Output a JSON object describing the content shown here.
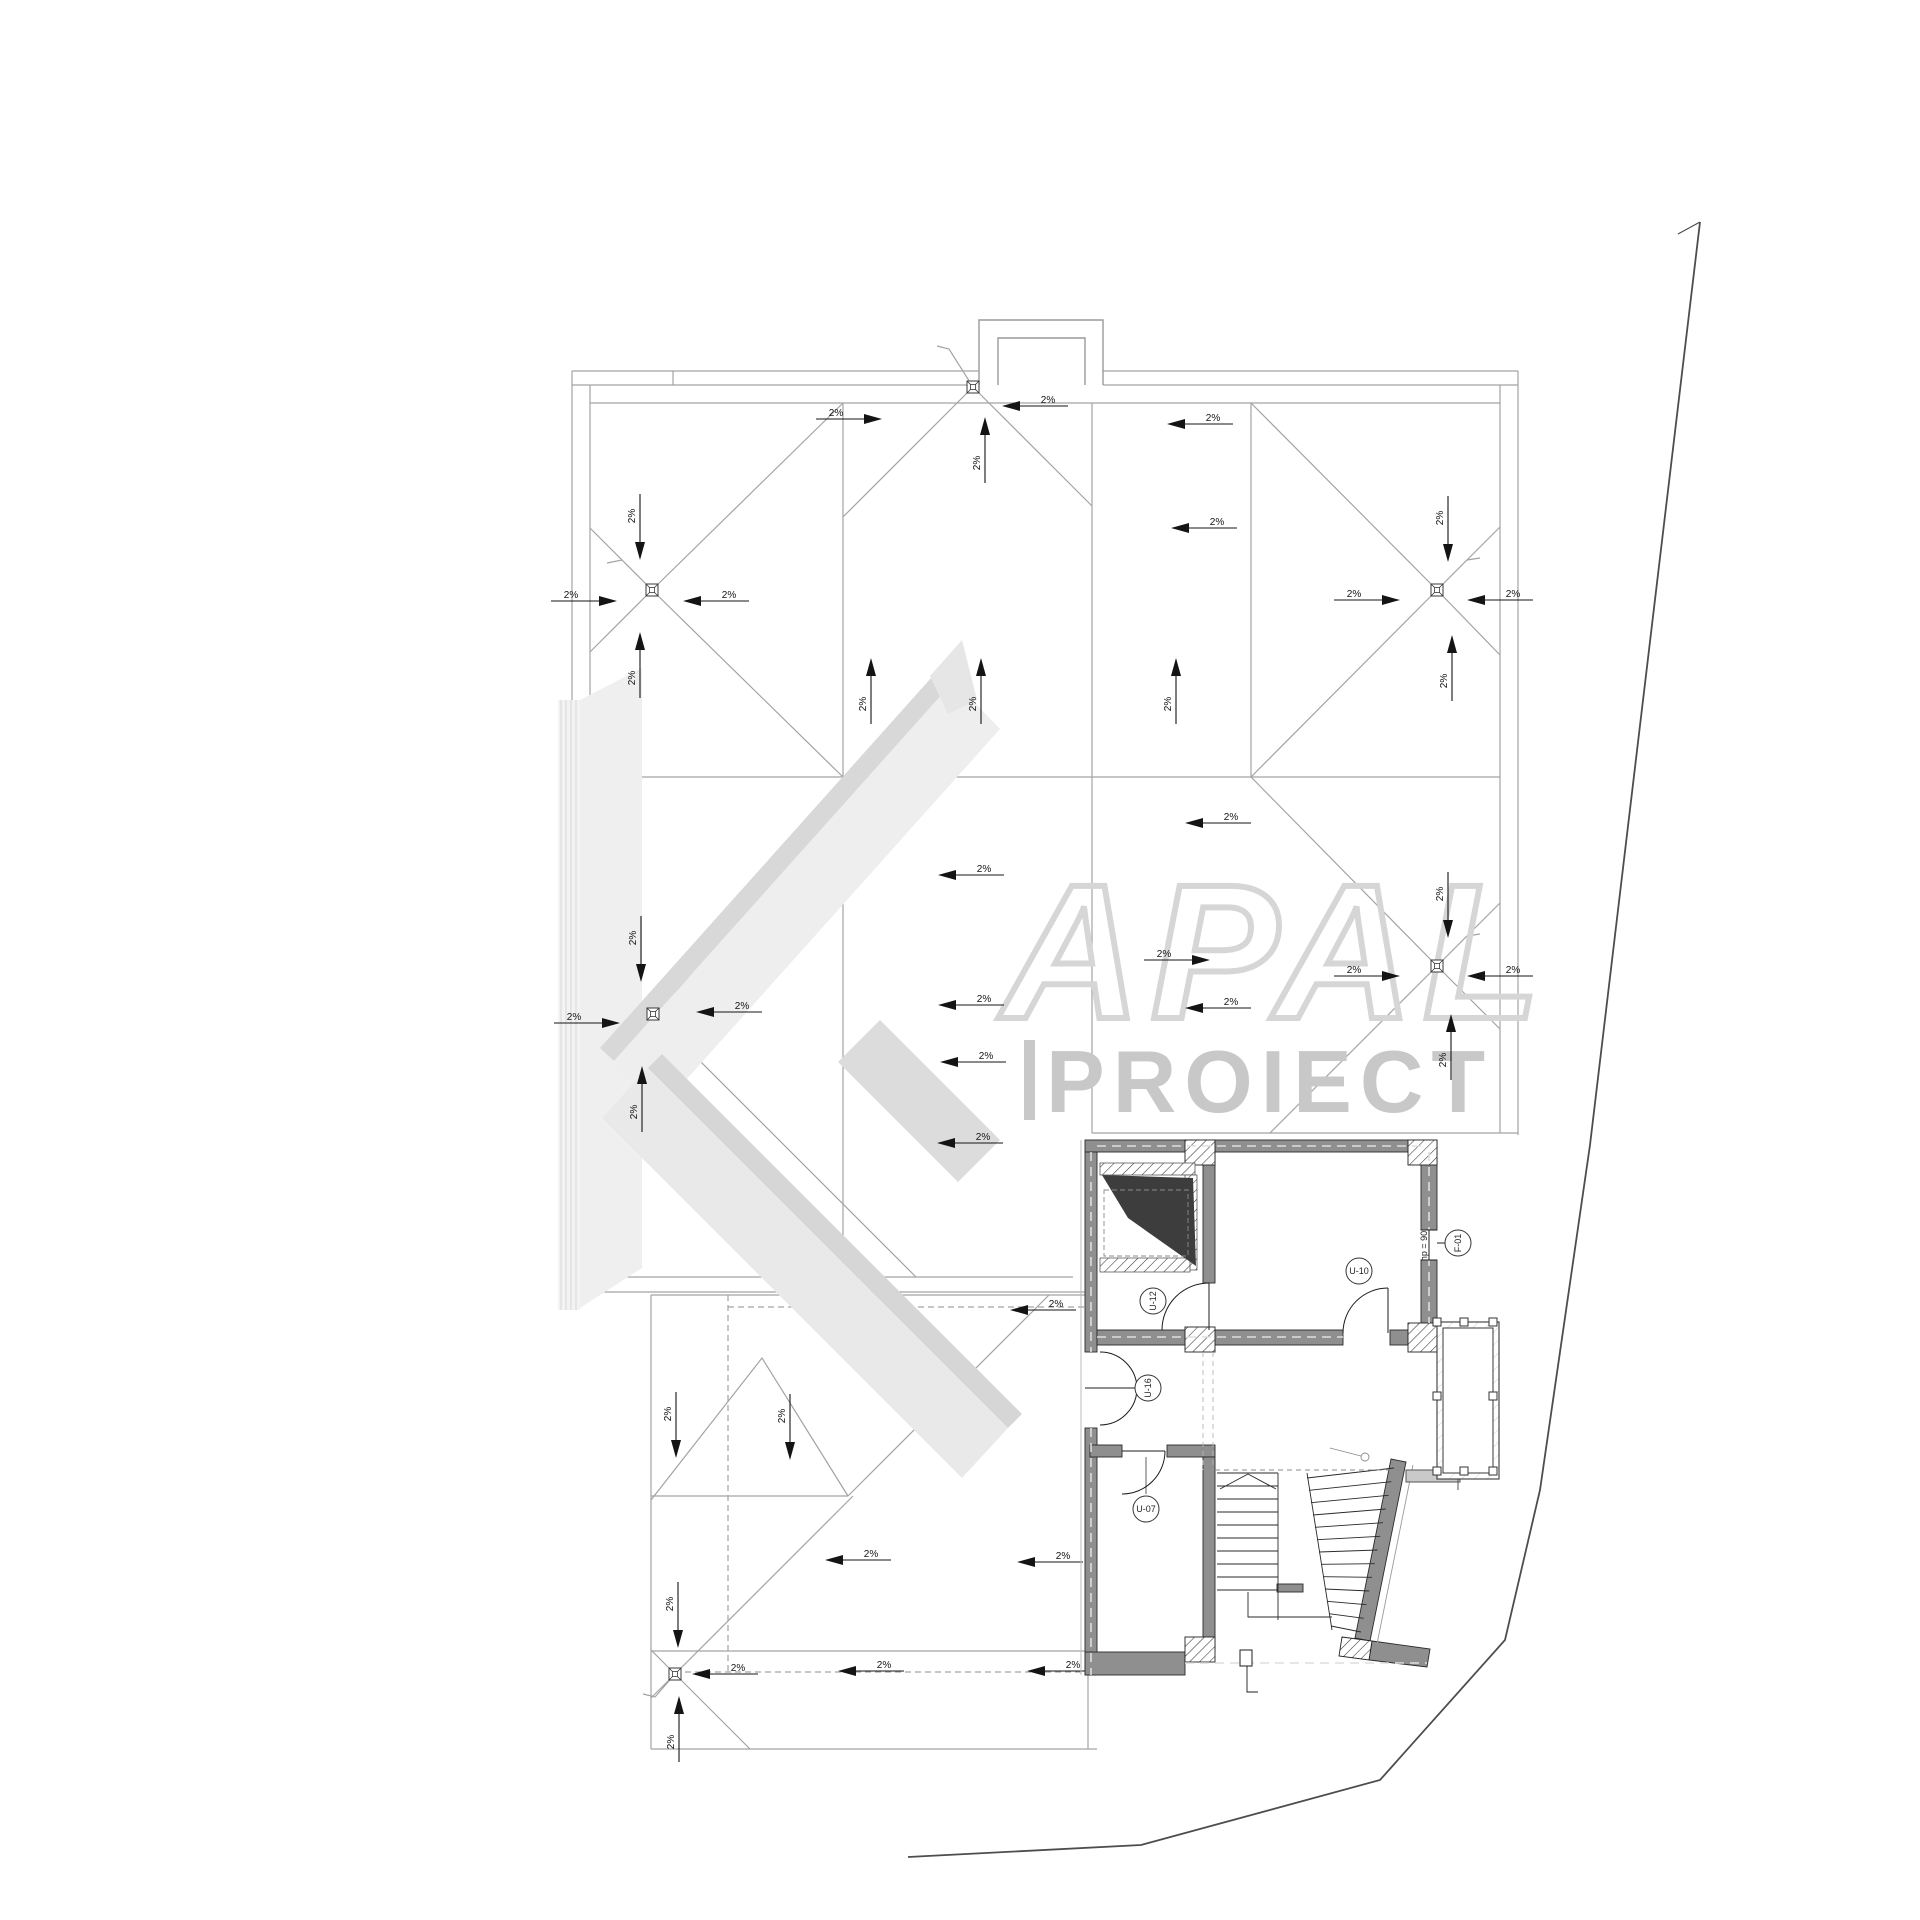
{
  "page": {
    "background": "#ffffff",
    "kind": "architectural roof and floor plan drawing"
  },
  "watermark": {
    "letters": "APAL",
    "proiect": "PROIECT",
    "outline_color": "#d6d6d6",
    "text_color": "#c8c8c8",
    "beam_light": "#ededed",
    "beam_edge": "#d8d8d8"
  },
  "colors": {
    "roof_line": "#a3a3a3",
    "dash_line": "#9a9a9a",
    "annotation": "#141414",
    "wall_fill": "#8f8f8f",
    "wall_edge": "#2b2b2b",
    "void_fill": "#3d3d3d",
    "boundary": "#4d4d4d"
  },
  "slope_annotations": [
    {
      "label": "2%",
      "x": 640,
      "y": 540,
      "dir": "down"
    },
    {
      "label": "2%",
      "x": 597,
      "y": 601,
      "dir": "right"
    },
    {
      "label": "2%",
      "x": 703,
      "y": 601,
      "dir": "left"
    },
    {
      "label": "2%",
      "x": 640,
      "y": 652,
      "dir": "up"
    },
    {
      "label": "2%",
      "x": 862,
      "y": 419,
      "dir": "right"
    },
    {
      "label": "2%",
      "x": 1022,
      "y": 406,
      "dir": "left"
    },
    {
      "label": "2%",
      "x": 985,
      "y": 437,
      "dir": "up"
    },
    {
      "label": "2%",
      "x": 871,
      "y": 678,
      "dir": "up"
    },
    {
      "label": "2%",
      "x": 981,
      "y": 678,
      "dir": "up"
    },
    {
      "label": "2%",
      "x": 1176,
      "y": 678,
      "dir": "up"
    },
    {
      "label": "2%",
      "x": 1187,
      "y": 424,
      "dir": "left"
    },
    {
      "label": "2%",
      "x": 1191,
      "y": 528,
      "dir": "left"
    },
    {
      "label": "2%",
      "x": 1380,
      "y": 600,
      "dir": "right"
    },
    {
      "label": "2%",
      "x": 1487,
      "y": 600,
      "dir": "left"
    },
    {
      "label": "2%",
      "x": 1448,
      "y": 542,
      "dir": "down"
    },
    {
      "label": "2%",
      "x": 1452,
      "y": 655,
      "dir": "up"
    },
    {
      "label": "2%",
      "x": 641,
      "y": 962,
      "dir": "down"
    },
    {
      "label": "2%",
      "x": 600,
      "y": 1023,
      "dir": "right"
    },
    {
      "label": "2%",
      "x": 716,
      "y": 1012,
      "dir": "left"
    },
    {
      "label": "2%",
      "x": 642,
      "y": 1086,
      "dir": "up"
    },
    {
      "label": "2%",
      "x": 958,
      "y": 875,
      "dir": "left"
    },
    {
      "label": "2%",
      "x": 960,
      "y": 1062,
      "dir": "left"
    },
    {
      "label": "2%",
      "x": 958,
      "y": 1005,
      "dir": "left"
    },
    {
      "label": "2%",
      "x": 1190,
      "y": 960,
      "dir": "right"
    },
    {
      "label": "2%",
      "x": 1205,
      "y": 823,
      "dir": "left"
    },
    {
      "label": "2%",
      "x": 1205,
      "y": 1008,
      "dir": "left"
    },
    {
      "label": "2%",
      "x": 1380,
      "y": 976,
      "dir": "right"
    },
    {
      "label": "2%",
      "x": 1487,
      "y": 976,
      "dir": "left"
    },
    {
      "label": "2%",
      "x": 1448,
      "y": 918,
      "dir": "down"
    },
    {
      "label": "2%",
      "x": 1451,
      "y": 1034,
      "dir": "up"
    },
    {
      "label": "2%",
      "x": 957,
      "y": 1143,
      "dir": "left"
    },
    {
      "label": "2%",
      "x": 1030,
      "y": 1310,
      "dir": "left"
    },
    {
      "label": "2%",
      "x": 676,
      "y": 1438,
      "dir": "down"
    },
    {
      "label": "2%",
      "x": 790,
      "y": 1440,
      "dir": "down"
    },
    {
      "label": "2%",
      "x": 845,
      "y": 1560,
      "dir": "left"
    },
    {
      "label": "2%",
      "x": 1037,
      "y": 1562,
      "dir": "left"
    },
    {
      "label": "2%",
      "x": 678,
      "y": 1628,
      "dir": "down"
    },
    {
      "label": "2%",
      "x": 679,
      "y": 1716,
      "dir": "up"
    },
    {
      "label": "2%",
      "x": 712,
      "y": 1674,
      "dir": "left"
    },
    {
      "label": "2%",
      "x": 858,
      "y": 1671,
      "dir": "left"
    },
    {
      "label": "2%",
      "x": 1047,
      "y": 1671,
      "dir": "left"
    }
  ],
  "drains": [
    {
      "x": 652,
      "y": 590
    },
    {
      "x": 653,
      "y": 1014
    },
    {
      "x": 973,
      "y": 387
    },
    {
      "x": 1437,
      "y": 590
    },
    {
      "x": 1437,
      "y": 966
    },
    {
      "x": 675,
      "y": 1674
    }
  ],
  "plan_tags": [
    {
      "id": "U-12",
      "x": 1153,
      "y": 1301,
      "rot": -90
    },
    {
      "id": "U-10",
      "x": 1359,
      "y": 1271,
      "rot": 0
    },
    {
      "id": "U-16",
      "x": 1148,
      "y": 1388,
      "rot": -90
    },
    {
      "id": "U-07",
      "x": 1146,
      "y": 1509,
      "rot": 0
    },
    {
      "id": "F-01",
      "x": 1458,
      "y": 1243,
      "rot": -90
    }
  ],
  "window_note": {
    "text": "hp = 90"
  }
}
